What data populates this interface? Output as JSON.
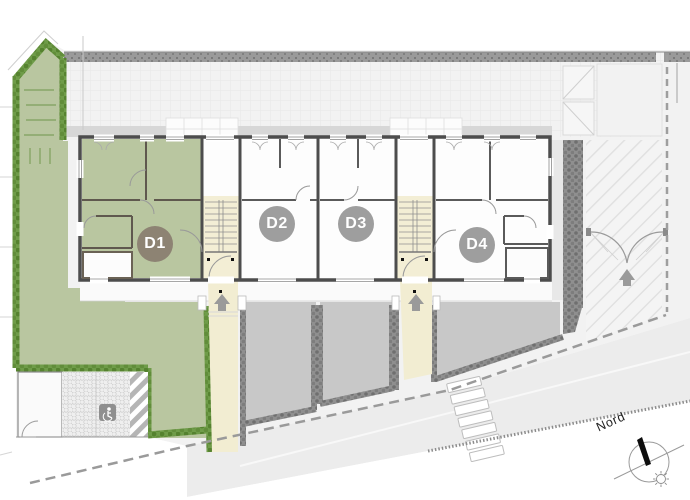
{
  "title": "Site plan with dwellings D1-D4",
  "plan": {
    "units": [
      {
        "label": "D1",
        "badge_color": "#8d8373",
        "floor_color": "#b9c6a0",
        "highlighted": true
      },
      {
        "label": "D2",
        "badge_color": "#9e9e9e",
        "floor_color": "#fdfdfd",
        "highlighted": false
      },
      {
        "label": "D3",
        "badge_color": "#9e9e9e",
        "floor_color": "#fdfdfd",
        "highlighted": false
      },
      {
        "label": "D4",
        "badge_color": "#9e9e9e",
        "floor_color": "#fdfdfd",
        "highlighted": false
      }
    ],
    "compass": {
      "label": "Nord"
    },
    "icons": {
      "accessible_parking": "wheelchair-badge",
      "entrance_arrow": "up-arrow",
      "gate": "double-swing-arcs",
      "compass_needle": "black-needle",
      "sun": "sun-rays"
    },
    "colors": {
      "lawn": "#b9c6a0",
      "hedge_green": "#6f9c49",
      "hedge_gray": "#8f8f8f",
      "stairwell_cream": "#f3eed5",
      "front_yard_paving": "#c8c8c8",
      "wall": "#4d4d4d",
      "street_surface": "#ececec",
      "boundary_dash": "#9a9a9a",
      "rear_terrace": "#f2f2f2"
    }
  }
}
